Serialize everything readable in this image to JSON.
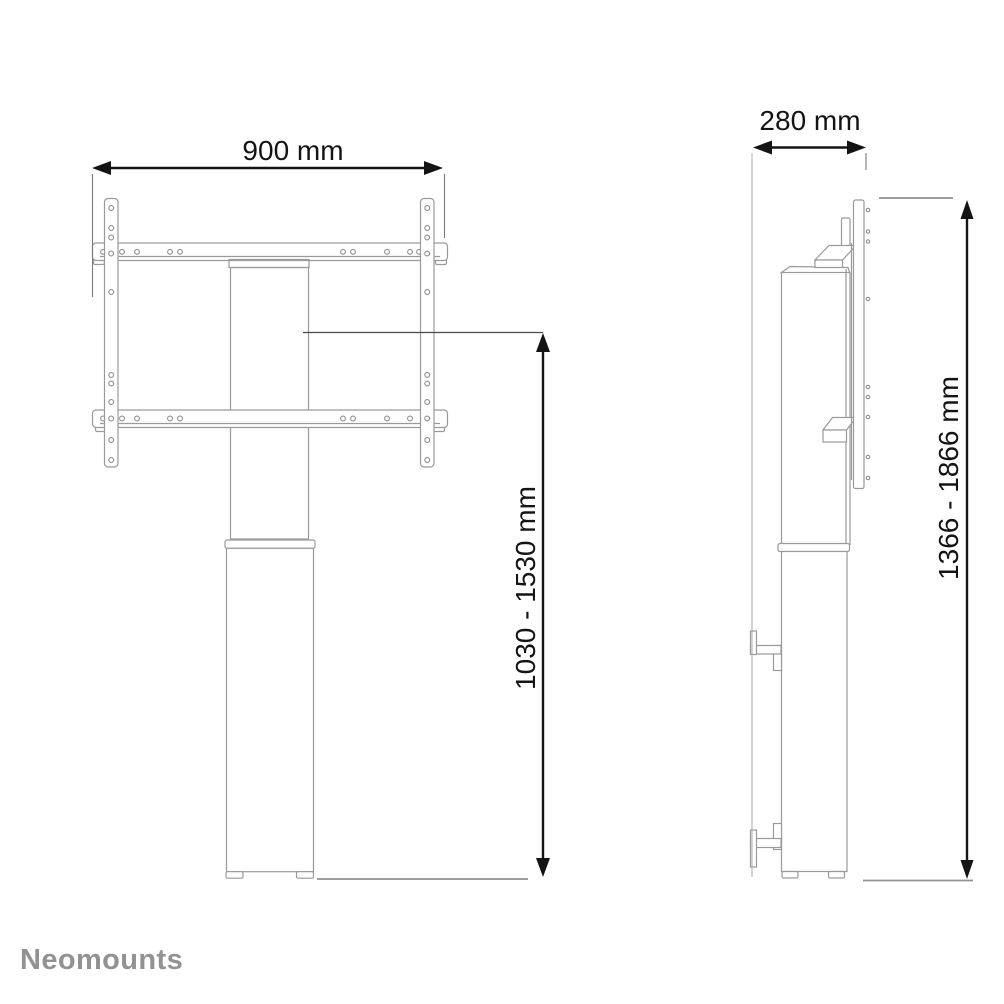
{
  "brand": {
    "logo_text": "Neomounts",
    "logo_color": "#929292"
  },
  "views": {
    "front": {
      "width_dimension_label": "900 mm",
      "height_dimension_label": "1030 - 1530 mm"
    },
    "side": {
      "depth_dimension_label": "280 mm",
      "height_dimension_label": "1366 - 1866 mm"
    }
  },
  "colors": {
    "background": "#ffffff",
    "dimension_line": "#141414",
    "drawing_line": "#9a9a9a",
    "reference_line": "#919191"
  }
}
